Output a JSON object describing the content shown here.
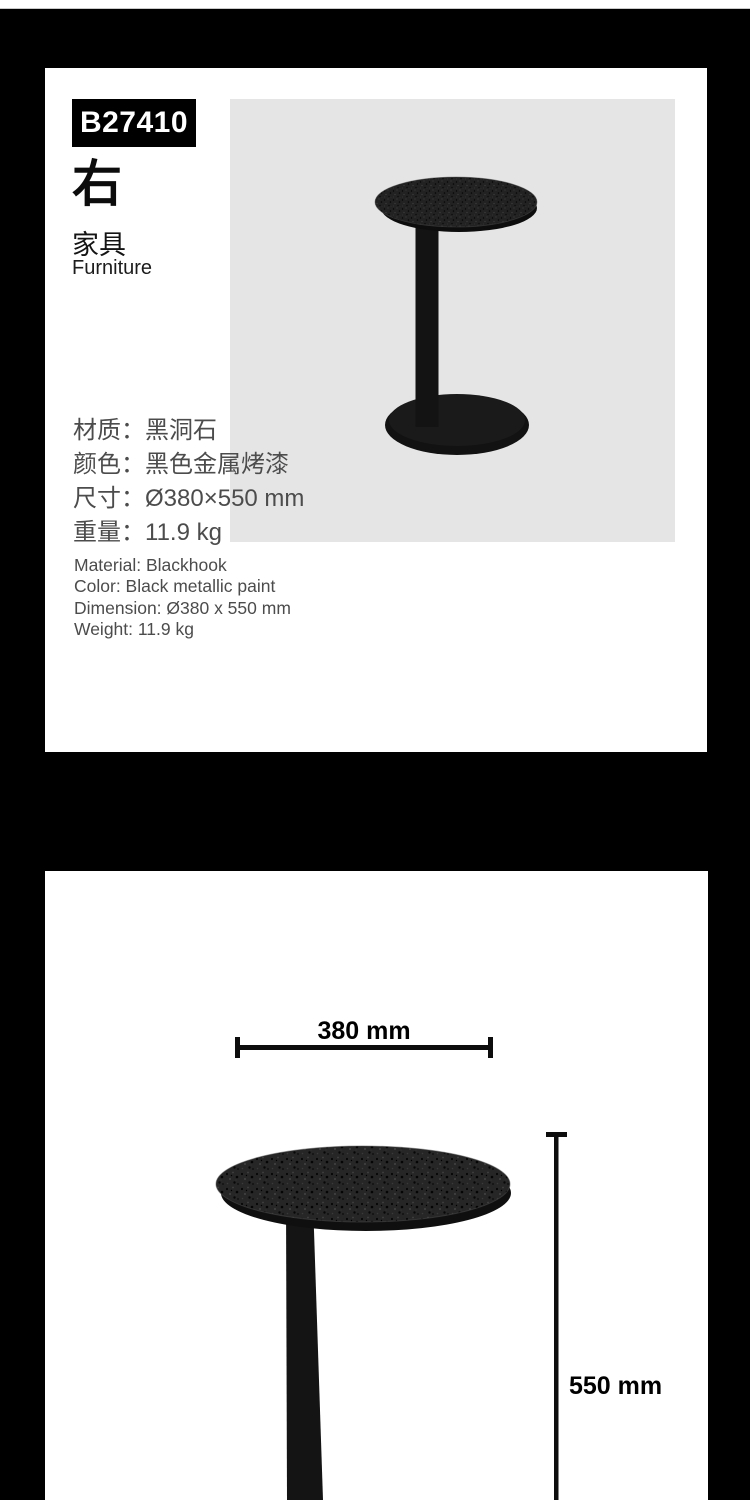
{
  "page": {
    "background": "#000000",
    "card_background": "#ffffff"
  },
  "product_card": {
    "model": "B27410",
    "title_cn": "右",
    "category_cn": "家具",
    "category_en": "Furniture",
    "photo_bg": "#e5e5e6",
    "specs_cn": [
      "材质：黑洞石",
      "颜色：黑色金属烤漆",
      "尺寸：Ø380×550 mm",
      "重量：11.9 kg"
    ],
    "specs_en": [
      "Material: Blackhook",
      "Color: Black metallic paint",
      "Dimension: Ø380 x 550 mm",
      "Weight: 11.9 kg"
    ]
  },
  "dimensions_card": {
    "width_label": "380 mm",
    "height_label": "550 mm"
  },
  "product_colors": {
    "table_black": "#141414",
    "speckle_base": "#262626"
  }
}
